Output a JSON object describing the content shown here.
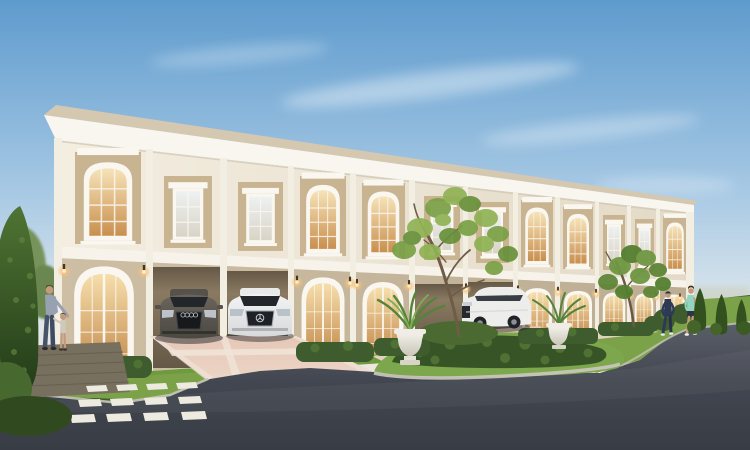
{
  "meta": {
    "type": "architectural-rendering",
    "subject": "Two-storey neoclassical cream townhome row at dusk with cars, landscaping and people",
    "time_of_day": "dusk",
    "visible_text": ""
  },
  "colors": {
    "sky_top": "#5E9BCD",
    "sky_mid": "#A6C8E4",
    "sky_low": "#DCE6EC",
    "sky_horizon": "#F0E9DC",
    "roof_tan": "#D5C8B0",
    "eave_white": "#F9F6EF",
    "trim_white": "#FAF7F0",
    "facade_light": "#F4EEE1",
    "facade_dark": "#E3D9C6",
    "ground_light": "#CDBEA4",
    "ground_dark": "#BCAD92",
    "panel_tan": "#C9B492",
    "string_white": "#F7F3EA",
    "pilaster": "#F3EEE2",
    "carport_hi": "#8A7A62",
    "carport_lo": "#655846",
    "glass_warm_hi": "#F6E3B8",
    "glass_warm_lo": "#C98F4E",
    "glass_cool_hi": "#EEF1F2",
    "glass_cool_lo": "#D8D4C6",
    "lamp_core": "#FFEFC4",
    "lamp_glow": "#F6C37C",
    "lawn": "#7BA249",
    "lawn_strip": "#6F9A40",
    "island_grass": "#7CA74D",
    "hedge": "#3E5C2D",
    "hedge_light": "#527536",
    "shrub_dark": "#375426",
    "bed_dark": "#3F5C2B",
    "topiary_light": "#4F7433",
    "topiary_dark": "#223A18",
    "cone_green": "#33511F",
    "bg_tree": "#77935B",
    "haze": "#C9CDB9",
    "trunk_brown": "#6F5C46",
    "leaf_light": "#8FB254",
    "leaf_mid": "#7AA045",
    "leaf_dark": "#67903A",
    "drive_hi": "#E6C7B6",
    "drive_lo": "#EBD5C6",
    "paver_band": "#F0E4D8",
    "walkway": "#E7D5C5",
    "road_hi": "#5A5F68",
    "road_mid": "#434751",
    "road_lo": "#383C44",
    "curb": "#C8C4B9",
    "deck": "#77705F",
    "stone": "#EDEAE0",
    "car_audi_hi": "#6A655C",
    "car_audi_lo": "#4B4842",
    "car_white_hi": "#F2F3F4",
    "car_white_lo": "#D7D9DB",
    "suv_white": "#EDEEEC",
    "car_glass": "#23272C",
    "chrome": "#C7CDD2",
    "urn_hi": "#F4F2EB",
    "urn_lo": "#C9C5B8",
    "skin": "#C49A7C",
    "man_shirt": "#97A1B2",
    "man_jeans": "#47536A",
    "child_top": "#CFC9BC",
    "jogger_navy": "#2E3A55",
    "jogger_teal": "#92D4C0",
    "shorts_dark": "#2F3540"
  },
  "building": {
    "storeys": 2,
    "visible_bays": 12,
    "upper_window_order": [
      "arched",
      "rect",
      "rect",
      "arched",
      "arched",
      "rect",
      "rect",
      "arched",
      "arched",
      "rect",
      "rect",
      "arched"
    ],
    "ground_bay_order": [
      "entry-door",
      "carport",
      "carport",
      "entry-door",
      "entry-door",
      "carport",
      "carport",
      "entry-door",
      "entry-door",
      "entry-door",
      "entry-door",
      "entry-door"
    ],
    "wall_lamps_lit": 13,
    "windows_lit": true
  },
  "vehicles": [
    {
      "name": "dark-gray-sedan",
      "position": "left carport",
      "facing": "front"
    },
    {
      "name": "white-sedan",
      "position": "second carport",
      "facing": "front"
    },
    {
      "name": "white-suv",
      "position": "right carport",
      "facing": "front-left"
    }
  ],
  "people": [
    {
      "name": "man-bending-to-child",
      "location": "left patio"
    },
    {
      "name": "toddler",
      "location": "left patio"
    },
    {
      "name": "jogger-navy-with-cap",
      "location": "right lawn"
    },
    {
      "name": "jogger-teal-top",
      "location": "right lawn"
    }
  ],
  "landscape": {
    "urn_planters": 2,
    "ornamental_trees": 2,
    "cone_topiaries_right": 3,
    "tall_topiary_left": 1,
    "stepping_stones": 12,
    "hedge_clusters": 6
  }
}
